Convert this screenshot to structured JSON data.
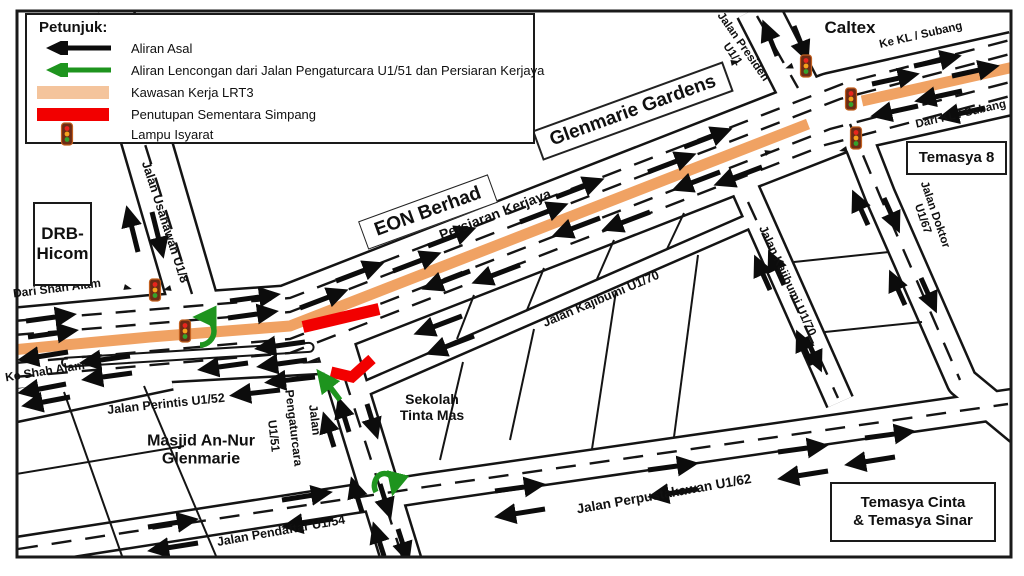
{
  "colors": {
    "flow_black": "#0c0c0c",
    "diversion_green": "#1e941e",
    "work_zone_orange": "#f0a263",
    "legend_work_zone": "#f4c49c",
    "closure_red": "#f20000"
  },
  "legend": {
    "title": "Petunjuk:",
    "items": [
      {
        "id": "original-flow",
        "label": "Aliran Asal"
      },
      {
        "id": "diversion-flow",
        "label": "Aliran Lencongan dari Jalan Pengaturcara U1/51 dan Persiaran Kerjaya"
      },
      {
        "id": "work-zone",
        "label": "Kawasan Kerja LRT3"
      },
      {
        "id": "junction-closure",
        "label": "Penutupan Sementara Simpang"
      },
      {
        "id": "traffic-light",
        "label": "Lampu Isyarat"
      }
    ]
  },
  "places": {
    "caltex": "Caltex",
    "drb_line1": "DRB-",
    "drb_line2": "Hicom",
    "temasya8": "Temasya 8",
    "temasya_cinta_line1": "Temasya Cinta",
    "temasya_cinta_line2": "& Temasya Sinar",
    "masjid_line1": "Masjid An-Nur",
    "masjid_line2": "Glenmarie",
    "sekolah_line1": "Sekolah",
    "sekolah_line2": "Tinta Mas",
    "eon": "EON Berhad",
    "glenmarie_gardens": "Glenmarie Gardens"
  },
  "roads": {
    "persiaran_kerjaya": "Persiaran Kerjaya",
    "usahawan": "Jalan Usahawan U1/8",
    "dari_shah_alam": "Dari Shah Alam",
    "ke_shah_alam": "Ke Shah Alam",
    "perintis": "Jalan Perintis U1/52",
    "pengaturcara_word1": "Jalan",
    "pengaturcara_word2": "Pengaturcara",
    "pengaturcara_word3": "U1/51",
    "kajibumi_h": "Jalan Kajibumi U1/70",
    "kajibumi_v": "Jalan Kajibumi U1/70",
    "presiden_line1": "Jalan Presiden",
    "presiden_line2": "U1/1",
    "ke_kl": "Ke KL / Subang",
    "dari_kl": "Dari KL / Subang",
    "doktor_line1": "Jalan Doktor",
    "doktor_line2": "U1/67",
    "perpustakawan": "Jalan Perpustakawan U1/62",
    "pendaftar": "Jalan Pendaftar U1/54"
  }
}
